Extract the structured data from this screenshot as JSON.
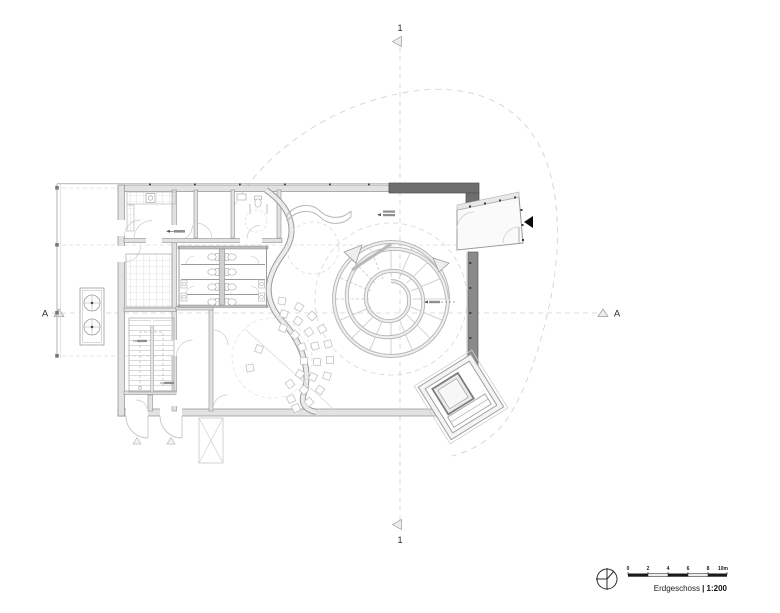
{
  "markers": {
    "top": "1",
    "bottom": "1",
    "left": "A",
    "right": "A"
  },
  "footer": {
    "floor_label": "Erdgeschoss",
    "scale_label": "| 1:200",
    "scale_ticks": [
      "0",
      "2",
      "4",
      "6",
      "8",
      "10m"
    ]
  },
  "colors": {
    "background": "#ffffff",
    "wall_dark": "#6e6e6e",
    "wall_light": "#e2e2e2",
    "linework": "#9b9b9b",
    "dashed_guides": "#d4d4d4",
    "entrance_arrow": "#0a0a0a",
    "scale_bar": "#1a1a1a",
    "text": "#2b2b2b"
  }
}
